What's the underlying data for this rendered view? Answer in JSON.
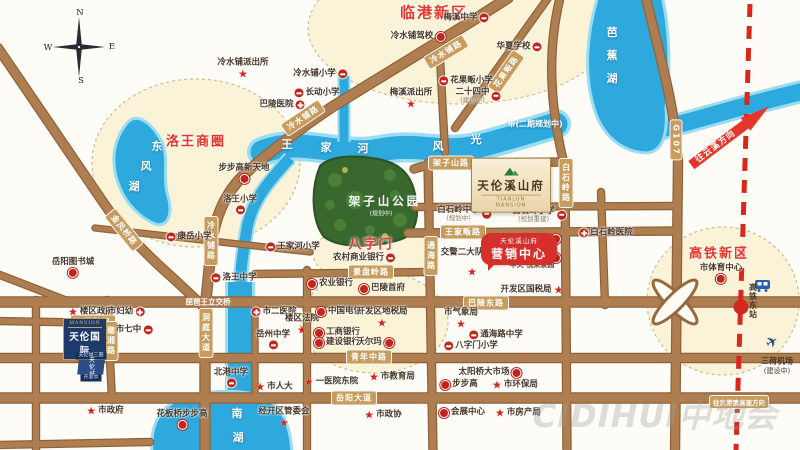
{
  "compass": {
    "n": "N",
    "e": "E",
    "s": "S",
    "w": "W"
  },
  "colors": {
    "road": "#ae7e50",
    "road_edge": "#8f6138",
    "water": "#2ea9de",
    "water_edge": "#9adcf2",
    "zone_fill": "#faf3d8",
    "park": "#39682f",
    "poi_red": "#c2251c",
    "title_red": "#e6372b",
    "badge": "#c79c5c",
    "railway": "#d8281e",
    "navy": "#1d3a6a"
  },
  "districts": [
    {
      "label": "临港新区",
      "x": 434,
      "y": 12,
      "big": true
    },
    {
      "label": "洛王商圈",
      "x": 196,
      "y": 140
    },
    {
      "label": "八字门",
      "x": 371,
      "y": 243
    },
    {
      "label": "高铁新区",
      "x": 719,
      "y": 252
    }
  ],
  "water_labels": [
    {
      "text": "东",
      "x": 157,
      "y": 146
    },
    {
      "text": "风",
      "x": 146,
      "y": 166
    },
    {
      "text": "湖",
      "x": 134,
      "y": 186
    },
    {
      "text": "王",
      "x": 287,
      "y": 144
    },
    {
      "text": "家",
      "x": 326,
      "y": 147
    },
    {
      "text": "河",
      "x": 363,
      "y": 148
    },
    {
      "text": "风",
      "x": 438,
      "y": 146
    },
    {
      "text": "光",
      "x": 476,
      "y": 139
    },
    {
      "text": "带(二期规划中)",
      "x": 535,
      "y": 124,
      "small": true
    },
    {
      "text": "芭",
      "x": 612,
      "y": 32
    },
    {
      "text": "蕉",
      "x": 612,
      "y": 55
    },
    {
      "text": "湖",
      "x": 612,
      "y": 78
    },
    {
      "text": "南",
      "x": 237,
      "y": 413
    },
    {
      "text": "湖",
      "x": 238,
      "y": 437
    }
  ],
  "road_labels": [
    {
      "text": "冷水铺路",
      "x": 303,
      "y": 118,
      "rot": -34
    },
    {
      "text": "冷水铺路",
      "x": 446,
      "y": 52,
      "rot": -31
    },
    {
      "text": "冷水铺路",
      "x": 211,
      "y": 241,
      "vertical": true
    },
    {
      "text": "金凤桥路",
      "x": 124,
      "y": 230,
      "rot": 51
    },
    {
      "text": "花果畈路",
      "x": 506,
      "y": 72,
      "rot": -55
    },
    {
      "text": "架子山路",
      "x": 451,
      "y": 163
    },
    {
      "text": "王家畈路",
      "x": 463,
      "y": 232
    },
    {
      "text": "白石岭路",
      "x": 566,
      "y": 183,
      "vertical": true
    },
    {
      "text": "通海路",
      "x": 431,
      "y": 256,
      "vertical": true
    },
    {
      "text": "巴陵东路",
      "x": 486,
      "y": 303
    },
    {
      "text": "青年中路",
      "x": 369,
      "y": 357
    },
    {
      "text": "岳阳大道",
      "x": 354,
      "y": 398
    },
    {
      "text": "五里牌路",
      "x": 93,
      "y": 322
    },
    {
      "text": "建湘路",
      "x": 111,
      "y": 341,
      "vertical": true
    },
    {
      "text": "洞庭大道",
      "x": 206,
      "y": 333,
      "vertical": true
    },
    {
      "text": "琵琶王立交桥",
      "x": 208,
      "y": 302,
      "plain": true
    },
    {
      "text": "景盘岭路",
      "x": 371,
      "y": 272
    },
    {
      "text": "G107",
      "x": 676,
      "y": 140,
      "vertical": true
    },
    {
      "text": "往京港澳高速方向",
      "x": 739,
      "y": 402,
      "small": true
    }
  ],
  "pois": [
    {
      "label": "冷水铺派出所",
      "x": 243,
      "y": 69,
      "icon": "star",
      "pos": "below"
    },
    {
      "label": "梅溪中学",
      "x": 466,
      "y": 18,
      "icon": "school",
      "pos": "right"
    },
    {
      "label": "冷水铺驾校",
      "x": 418,
      "y": 37,
      "icon": "dot",
      "pos": "right"
    },
    {
      "label": "华夏学校",
      "x": 519,
      "y": 47,
      "icon": "school",
      "pos": "right"
    },
    {
      "label": "冷水铺小学",
      "x": 320,
      "y": 74,
      "icon": "school",
      "pos": "right"
    },
    {
      "label": "花果畈小学",
      "x": 466,
      "y": 81,
      "icon": "school",
      "pos": "left"
    },
    {
      "label": "长动小学",
      "x": 317,
      "y": 93,
      "icon": "school",
      "pos": "left"
    },
    {
      "label": "二十四中",
      "x": 478,
      "y": 96,
      "icon": "school",
      "pos": "right",
      "sub": "(建设中)"
    },
    {
      "label": "梅溪派出所",
      "x": 411,
      "y": 99,
      "icon": "star",
      "pos": "above"
    },
    {
      "label": "巴陵医院",
      "x": 282,
      "y": 105,
      "icon": "hosp",
      "pos": "right"
    },
    {
      "label": "步步高新天地",
      "x": 244,
      "y": 174,
      "icon": "dot",
      "pos": "above"
    },
    {
      "label": "洛王小学",
      "x": 240,
      "y": 205,
      "icon": "school",
      "pos": "above"
    },
    {
      "label": "康岳小学",
      "x": 189,
      "y": 237,
      "icon": "school",
      "pos": "left"
    },
    {
      "label": "王家河小学",
      "x": 293,
      "y": 247,
      "icon": "school",
      "pos": "left"
    },
    {
      "label": "洛王中学",
      "x": 234,
      "y": 278,
      "icon": "school",
      "pos": "left"
    },
    {
      "label": "岳阳图书城",
      "x": 73,
      "y": 268,
      "icon": "dot",
      "pos": "below"
    },
    {
      "label": "楼区政府",
      "x": 91,
      "y": 312,
      "icon": "star",
      "pos": "left"
    },
    {
      "label": "市妇幼",
      "x": 126,
      "y": 312,
      "icon": "hosp",
      "pos": "right"
    },
    {
      "label": "市七中",
      "x": 134,
      "y": 330,
      "icon": "school",
      "pos": "right"
    },
    {
      "label": "市政府",
      "x": 105,
      "y": 411,
      "icon": "star",
      "pos": "left"
    },
    {
      "label": "花板桥步步高",
      "x": 182,
      "y": 420,
      "icon": "dot",
      "pos": "above"
    },
    {
      "label": "市二医院",
      "x": 274,
      "y": 312,
      "icon": "hosp",
      "pos": "left"
    },
    {
      "label": "楼区法院",
      "x": 302,
      "y": 325,
      "icon": "star",
      "pos": "above"
    },
    {
      "label": "岳州中学",
      "x": 273,
      "y": 340,
      "icon": "school",
      "pos": "below"
    },
    {
      "label": "北港中学",
      "x": 231,
      "y": 378,
      "icon": "school",
      "pos": "below"
    },
    {
      "label": "市人大",
      "x": 274,
      "y": 387,
      "icon": "star",
      "pos": "left"
    },
    {
      "label": "一医院东院",
      "x": 331,
      "y": 382,
      "icon": "star",
      "pos": "left"
    },
    {
      "label": "农业银行",
      "x": 330,
      "y": 284,
      "icon": "dot",
      "pos": "left"
    },
    {
      "label": "巴陵首府",
      "x": 382,
      "y": 289,
      "icon": "dot",
      "pos": "left"
    },
    {
      "label": "中国电信",
      "x": 339,
      "y": 312,
      "icon": "dot",
      "pos": "left"
    },
    {
      "label": "开发区地税局",
      "x": 382,
      "y": 318,
      "icon": "star",
      "pos": "above"
    },
    {
      "label": "工商银行",
      "x": 337,
      "y": 333,
      "icon": "dot",
      "pos": "left"
    },
    {
      "label": "建设银行",
      "x": 337,
      "y": 343,
      "icon": "dot",
      "pos": "left"
    },
    {
      "label": "沃尔玛",
      "x": 375,
      "y": 343,
      "icon": "dot",
      "pos": "right"
    },
    {
      "label": "开发区国税局",
      "x": 532,
      "y": 290,
      "icon": "star",
      "pos": "right"
    },
    {
      "label": "市气象局",
      "x": 461,
      "y": 319,
      "icon": "star",
      "pos": "above"
    },
    {
      "label": "通海路中学",
      "x": 496,
      "y": 335,
      "icon": "school",
      "pos": "left"
    },
    {
      "label": "八字门小学",
      "x": 471,
      "y": 346,
      "icon": "school",
      "pos": "left"
    },
    {
      "label": "太阳桥大市场",
      "x": 490,
      "y": 373,
      "icon": "dot",
      "pos": "right"
    },
    {
      "label": "市教育局",
      "x": 392,
      "y": 377,
      "icon": "star",
      "pos": "left"
    },
    {
      "label": "经开区管委会",
      "x": 284,
      "y": 418,
      "icon": "star",
      "pos": "above"
    },
    {
      "label": "市政协",
      "x": 383,
      "y": 415,
      "icon": "star",
      "pos": "left"
    },
    {
      "label": "会展中心",
      "x": 462,
      "y": 413,
      "icon": "dot",
      "pos": "left"
    },
    {
      "label": "市房产局",
      "x": 518,
      "y": 413,
      "icon": "star",
      "pos": "left"
    },
    {
      "label": "步步高",
      "x": 459,
      "y": 385,
      "icon": "dot",
      "pos": "left"
    },
    {
      "label": "市环保局",
      "x": 515,
      "y": 385,
      "icon": "star",
      "pos": "left"
    },
    {
      "label": "白石岭中学",
      "x": 464,
      "y": 214,
      "icon": "school",
      "pos": "right",
      "sub": "(规划中)"
    },
    {
      "label": "白石岭小学",
      "x": 539,
      "y": 215,
      "icon": "school",
      "pos": "right",
      "sub": "(规划重建)"
    },
    {
      "label": "白石岭医院",
      "x": 606,
      "y": 233,
      "icon": "hosp",
      "pos": "left"
    },
    {
      "label": "交警二大队",
      "x": 462,
      "y": 253,
      "icon": "none",
      "pos": "left"
    },
    {
      "label": "市体育中心",
      "x": 721,
      "y": 274,
      "icon": "dot",
      "pos": "below"
    },
    {
      "label": "农村商业银行",
      "x": 364,
      "y": 258,
      "icon": "school",
      "pos": "right"
    },
    {
      "label": "中天·悦荣家园",
      "x": 532,
      "y": 266,
      "icon": "none",
      "pos": "left",
      "tiny": true
    },
    {
      "label": "",
      "x": 557,
      "y": 239,
      "icon": "dot",
      "pos": "left"
    },
    {
      "label": "",
      "x": 557,
      "y": 258,
      "icon": "dot",
      "pos": "left"
    }
  ],
  "park": {
    "name": "架子山公园",
    "sub": "(规划中)"
  },
  "projects": {
    "xishanfu": {
      "name": "天伦溪山府",
      "en": "TIANLUN MANSION"
    },
    "marketing": {
      "tag": "天伦溪山府",
      "name": "营销中心",
      "star": "★"
    },
    "mansion": {
      "brand": "MANSION",
      "name": "天伦国际"
    },
    "parcels": [
      "天伦城三期",
      "天伦城",
      "开发中"
    ]
  },
  "rail": {
    "arrow": "往云溪方向",
    "station": "高铁东站",
    "airport": "三荷机场",
    "airport_sub": "(建设中)"
  },
  "watermark": "CIDIHUI中地会"
}
